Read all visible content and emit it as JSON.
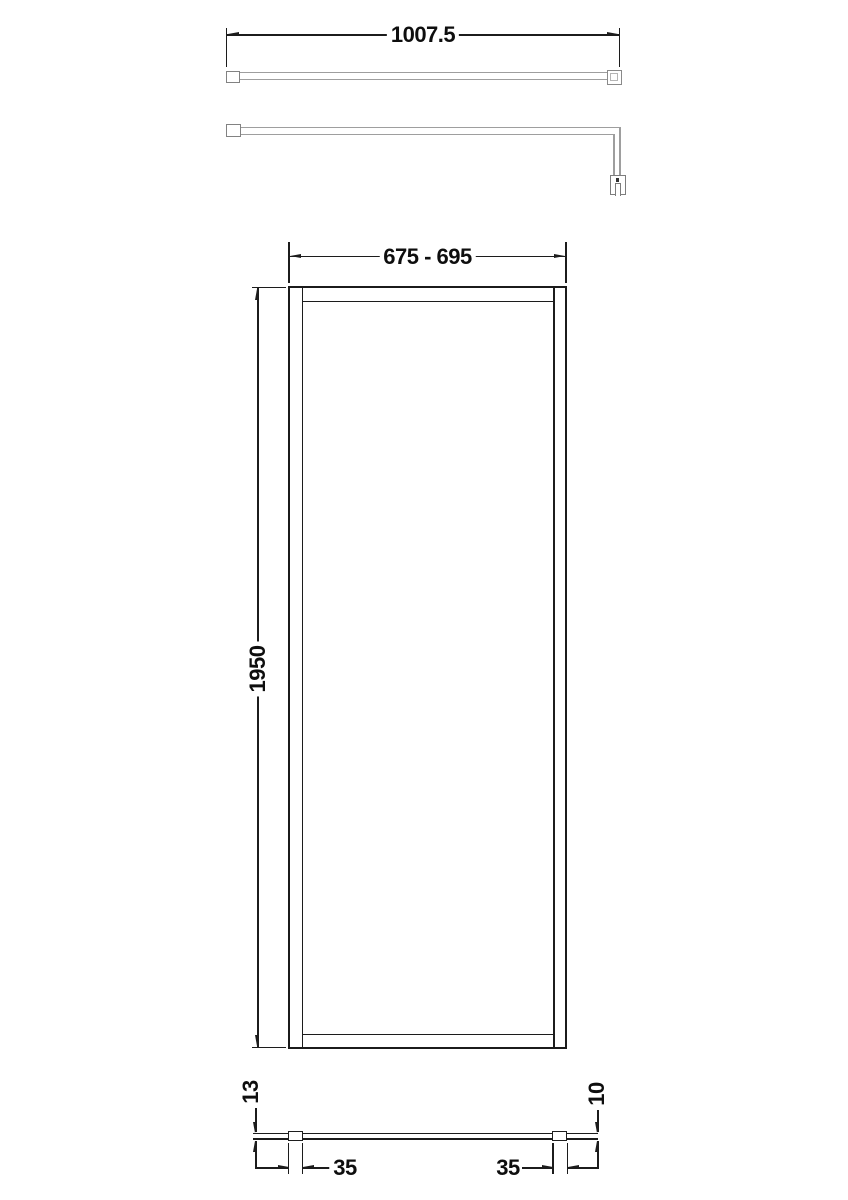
{
  "drawing": {
    "kind": "shower-screen-technical-drawing",
    "colors": {
      "outline_dark": "#1c1c1c",
      "outline_gray": "#9e9e9e",
      "fitting_gray": "#7d7d7d",
      "text": "#0e0e0e",
      "background": "#ffffff"
    },
    "dimensions": {
      "support_bar_length": {
        "label": "1007.5"
      },
      "screen_width_range": {
        "label": "675 - 695"
      },
      "screen_height": {
        "label": "1950"
      },
      "frame_depth": {
        "label": "13"
      },
      "glass_thickness": {
        "label": "10"
      },
      "left_profile_width": {
        "label": "35"
      },
      "right_profile_width": {
        "label": "35"
      }
    }
  }
}
